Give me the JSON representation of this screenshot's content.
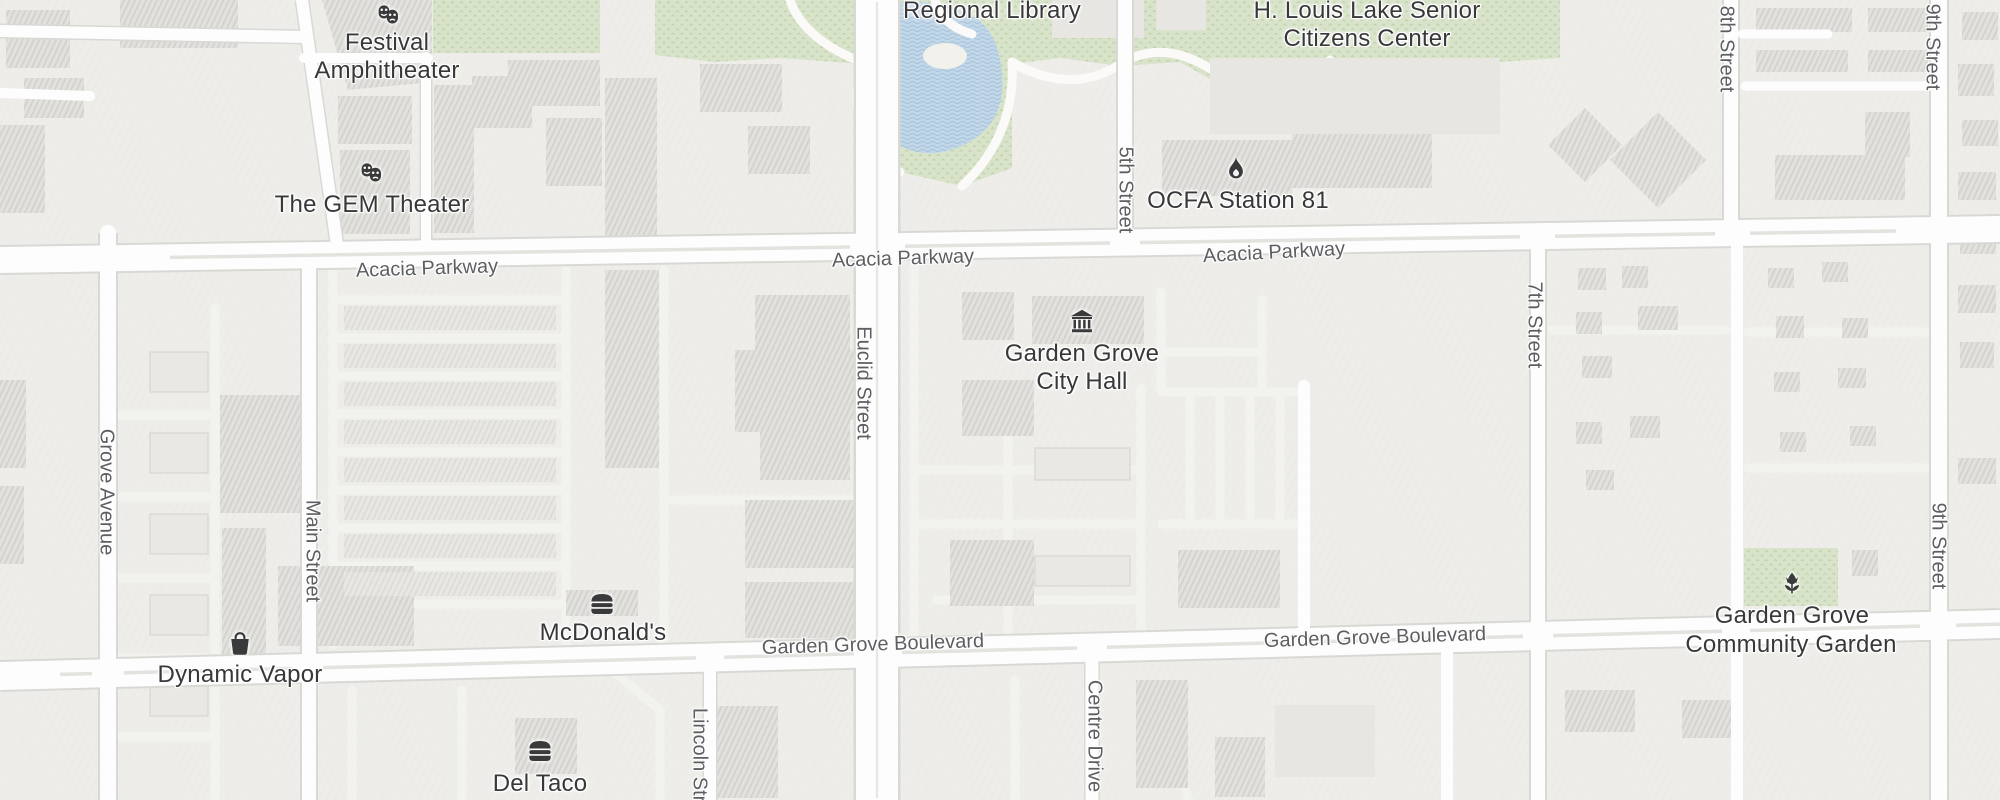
{
  "app": "map-view",
  "pois": {
    "festival_amphitheater": {
      "line1": "Festival",
      "line2": "Amphitheater",
      "icon": "theater-masks-icon"
    },
    "gem_theater": {
      "label": "The GEM Theater",
      "icon": "theater-masks-icon"
    },
    "regional_library": {
      "label": "Regional Library"
    },
    "senior_center": {
      "line1": "H. Louis Lake Senior",
      "line2": "Citizens Center"
    },
    "ocfa_station": {
      "label": "OCFA Station 81",
      "icon": "fire-icon"
    },
    "city_hall": {
      "line1": "Garden Grove",
      "line2": "City Hall",
      "icon": "government-building-icon"
    },
    "mcdonalds": {
      "label": "McDonald's",
      "icon": "burger-icon"
    },
    "dynamic_vapor": {
      "label": "Dynamic Vapor",
      "icon": "shopping-bag-icon"
    },
    "del_taco": {
      "label": "Del Taco",
      "icon": "burger-icon"
    },
    "community_garden": {
      "line1": "Garden Grove",
      "line2": "Community Garden",
      "icon": "flower-icon"
    }
  },
  "streets": {
    "acacia_parkway": "Acacia Parkway",
    "garden_grove_boulevard": "Garden Grove Boulevard",
    "grove_avenue": "Grove Avenue",
    "main_street": "Main Street",
    "euclid_street": "Euclid Street",
    "fifth_street": "5th Street",
    "seventh_street": "7th Street",
    "eighth_street": "8th Street",
    "ninth_street": "9th Street",
    "lincoln_street": "Lincoln Street",
    "centre_drive": "Centre Drive"
  },
  "colors": {
    "land": "#eeede9",
    "road": "#fdfdfd",
    "road_casing": "#d8d9d5",
    "minor_road": "#f2f2ef",
    "building": "#e2e1dd",
    "park": "#d8e3ca",
    "water": "#c2d7e8",
    "poi_text": "#38383a",
    "street_text": "#5d5e62",
    "icon": "#3a3a3c"
  }
}
